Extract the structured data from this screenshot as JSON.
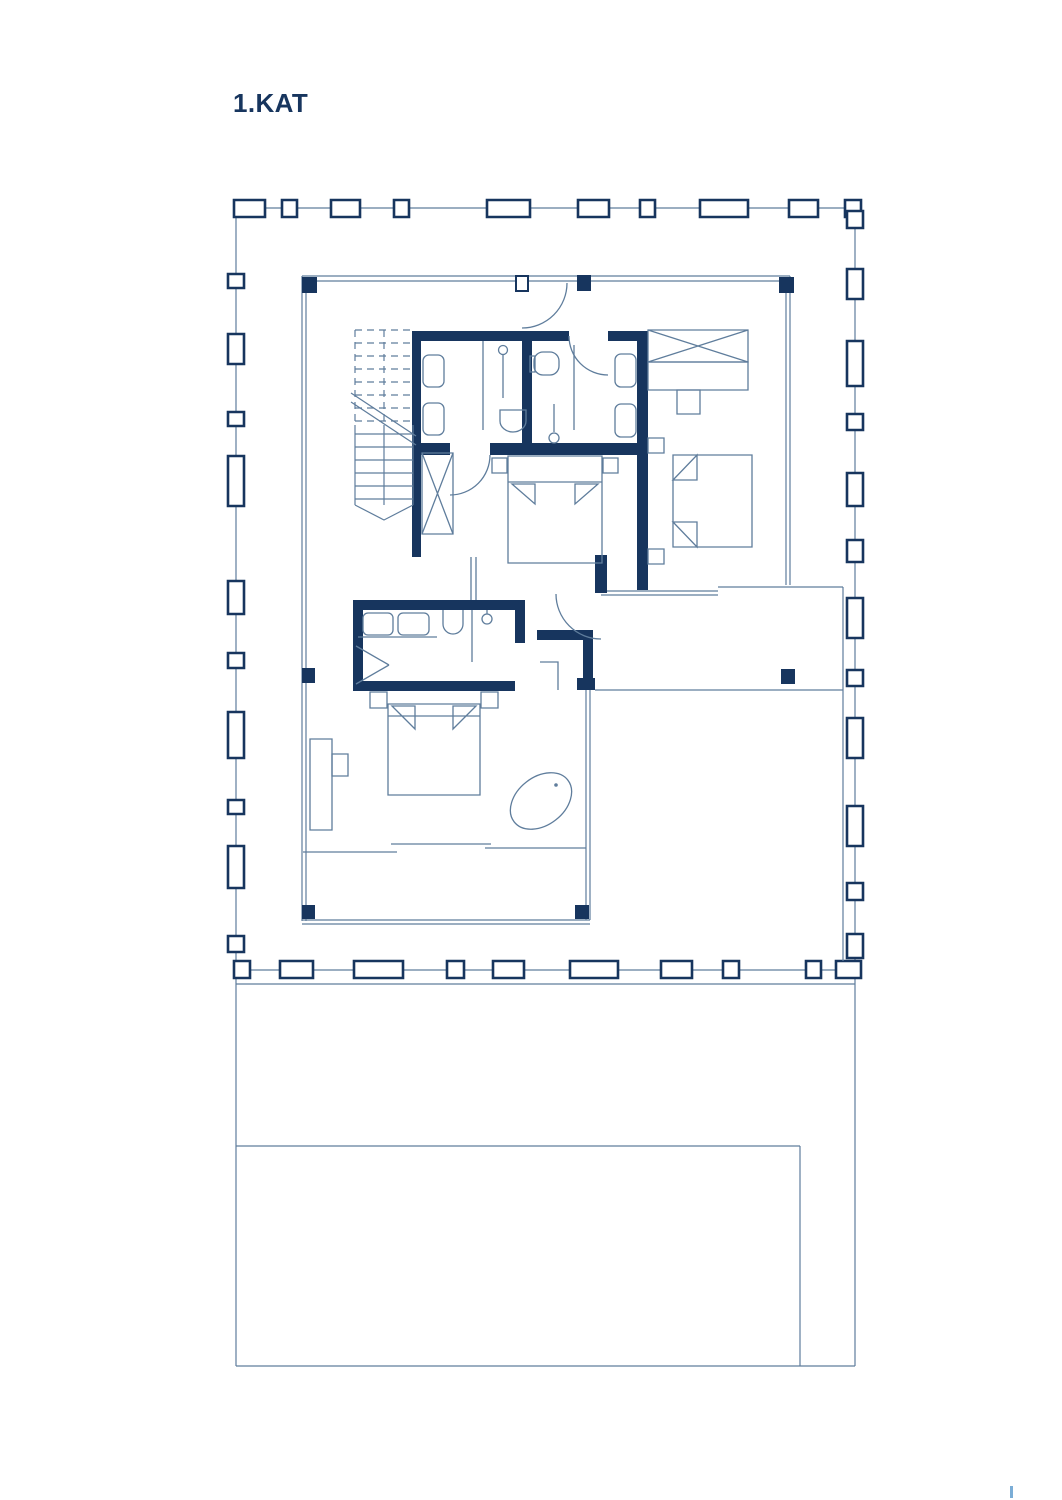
{
  "page": {
    "title": "1.KAT"
  },
  "colors": {
    "navy": "#17355e",
    "line": "#5f7d9c",
    "mark": "#7badd6",
    "bg": "#ffffff"
  },
  "plan": {
    "drawing_type": "floor-plan",
    "fixtures": [
      "staircase",
      "elevator-shaft",
      "wardrobe",
      "dressing-cabinets",
      "double-bed-right",
      "double-bed-middle",
      "double-bed-master",
      "toilet",
      "bidet",
      "washbasins",
      "shower-head",
      "freestanding-bathtub",
      "desk",
      "nightstands",
      "railing-posts",
      "terrace",
      "lower-court"
    ]
  }
}
